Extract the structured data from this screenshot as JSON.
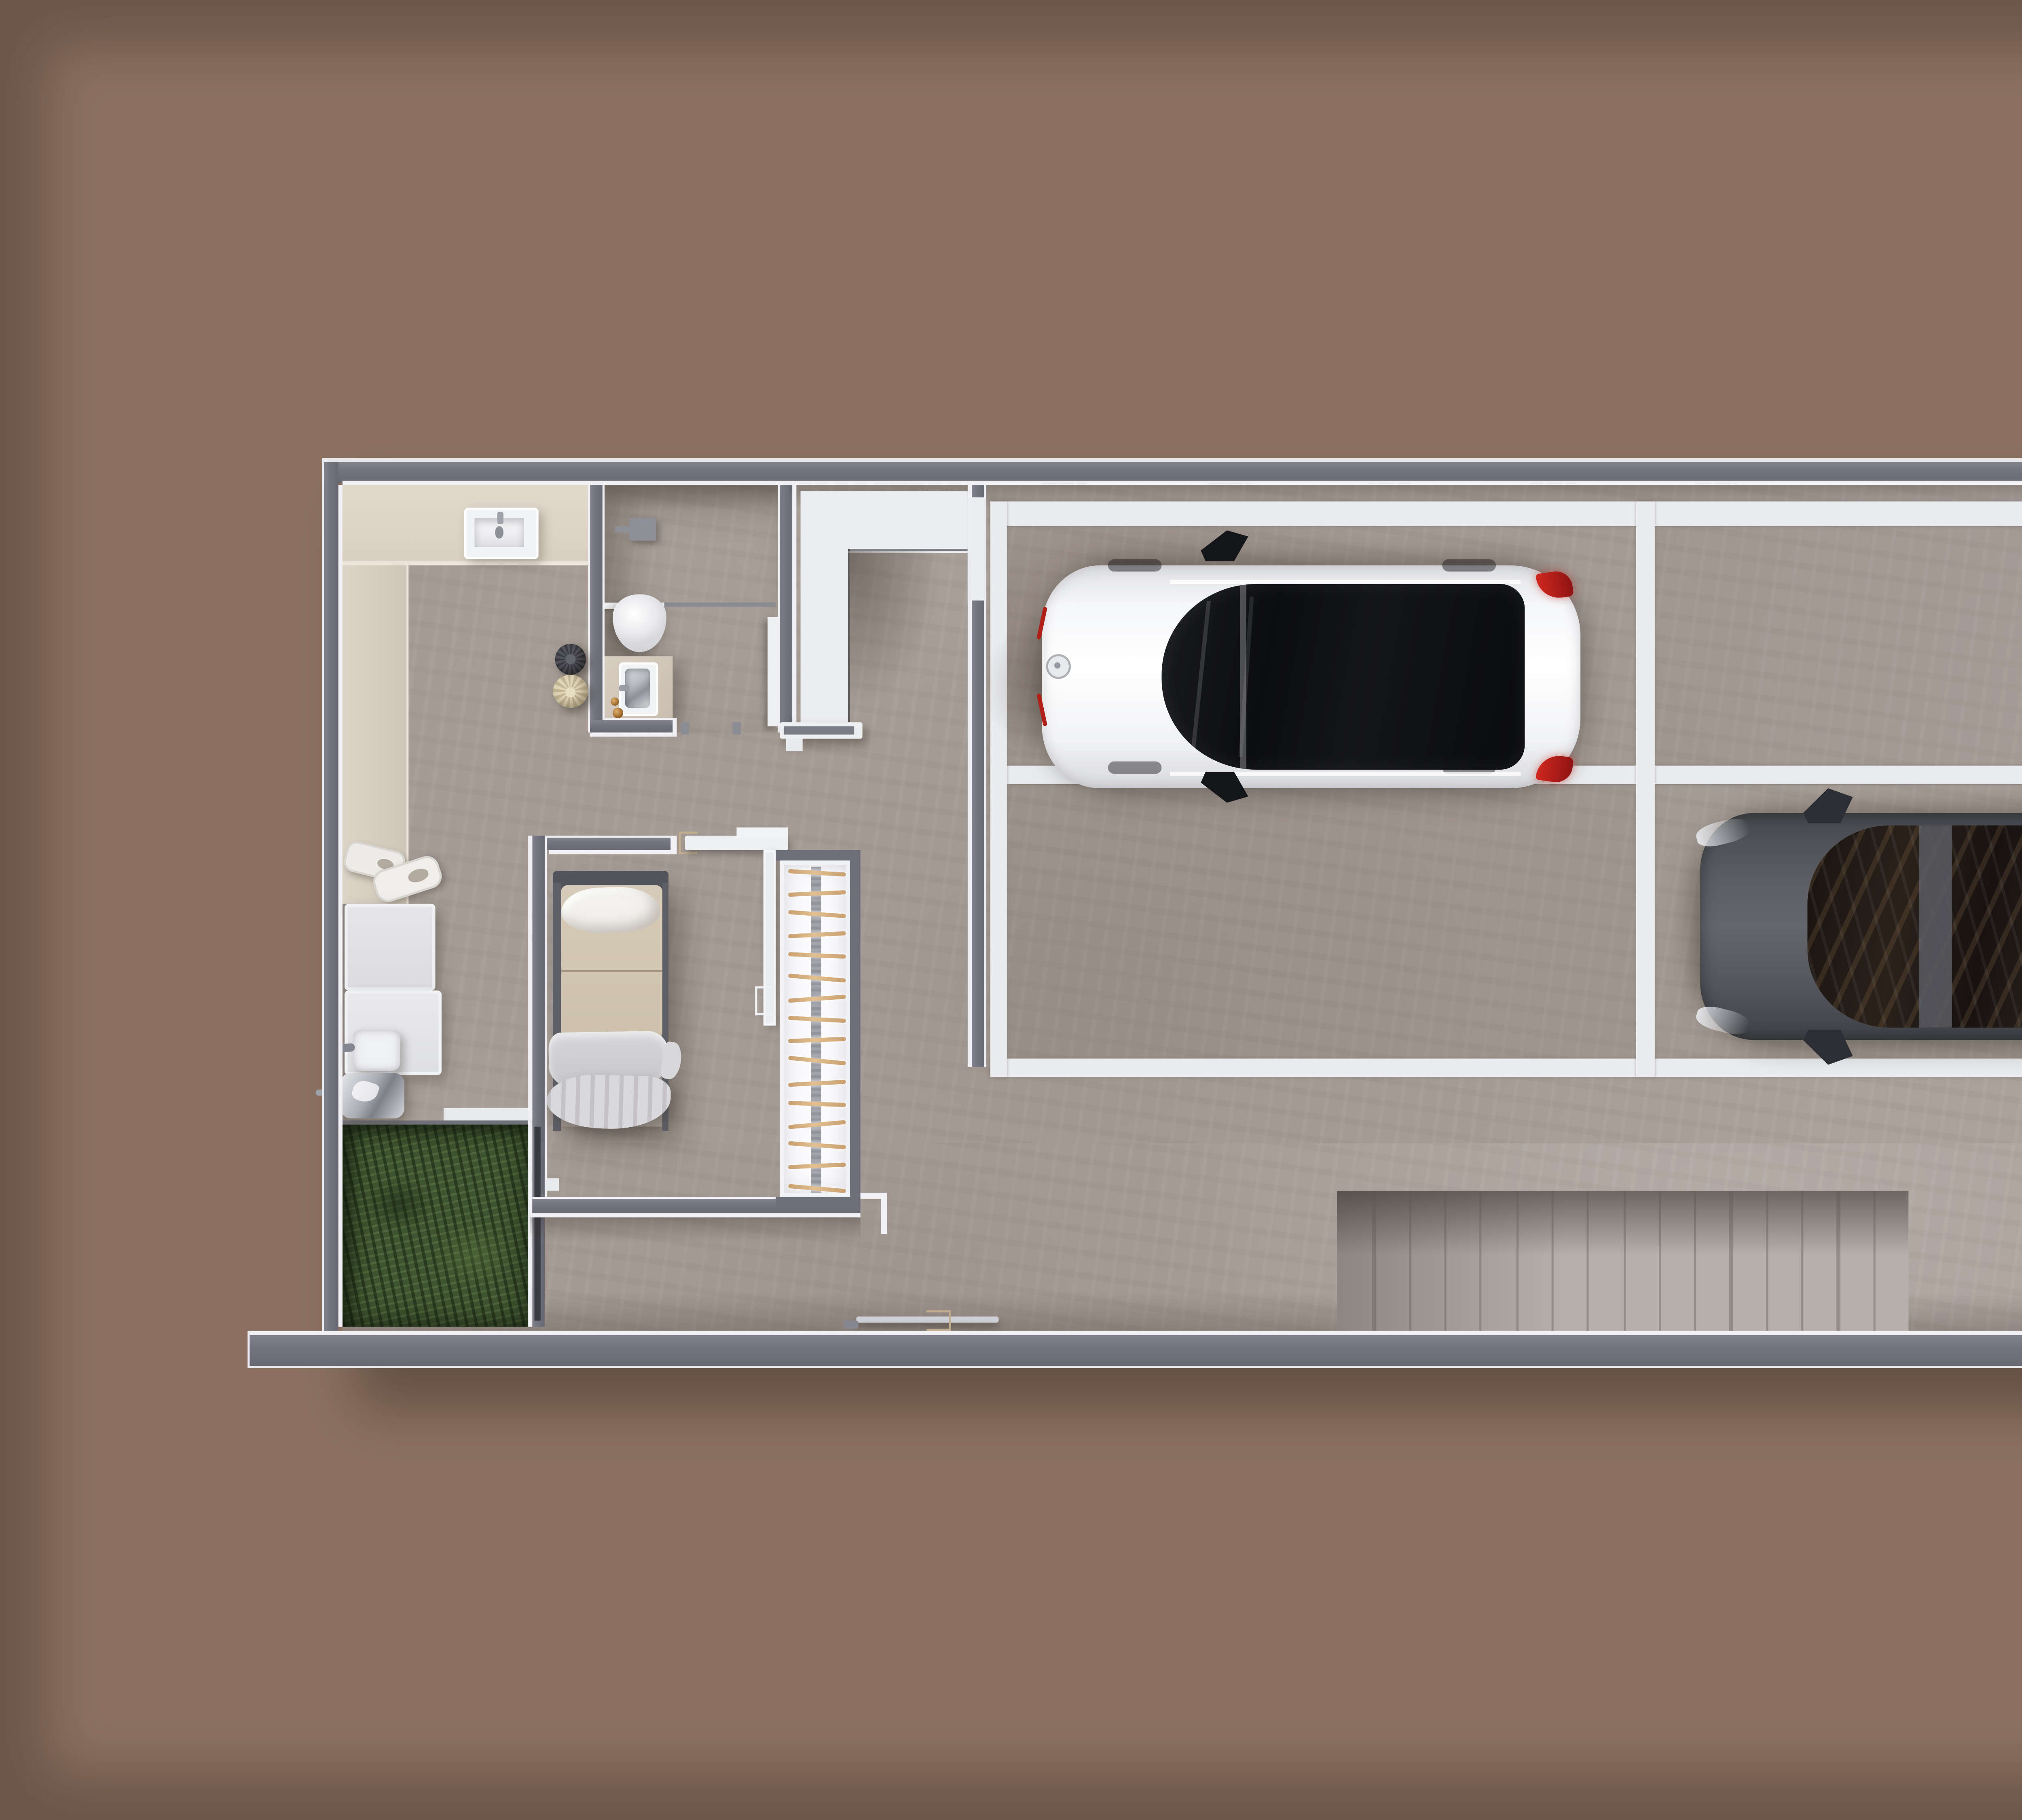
{
  "scene": {
    "kind": "architectural 3d floor plan, top-down render",
    "level": "ground / garage level with two parked cars"
  },
  "colors": {
    "background": "#8c7161",
    "wall": "#73747f",
    "trim": "#f1f1f5",
    "floor": "#aba19b",
    "floor_light": "#b7b0ab",
    "beige": "#d9cfc2",
    "white_floor": "#ecedf0",
    "grass": "#3f5430",
    "wood": "#c89f6f",
    "ramp": "#b6afab",
    "dark_box": "#4c4c55",
    "parking_line": "#eaecef",
    "white_car": "#f5f6f8",
    "dark_car": "#54565c",
    "red_light": "#c22018",
    "amber": "#a06a30",
    "tan": "#c2ad8f"
  },
  "rooms": [
    {
      "name": "kitchen",
      "features": [
        "l-shaped-counter",
        "sink",
        "appliances",
        "trays",
        "pan",
        "pot"
      ]
    },
    {
      "name": "bathroom",
      "features": [
        "toilet",
        "vanity-sink",
        "shower-fixture",
        "glass-screen",
        "door-leaf"
      ]
    },
    {
      "name": "entry-hall",
      "features": [
        "white-l-floor",
        "landing-rail"
      ]
    },
    {
      "name": "bedroom",
      "features": [
        "single-bed",
        "window-wall"
      ]
    },
    {
      "name": "stairwell",
      "features": [
        "wood-treads",
        "center-stringer"
      ]
    },
    {
      "name": "garage",
      "features": [
        "4-parking-bays",
        "white-markings"
      ]
    },
    {
      "name": "garden-patch",
      "features": [
        "grass"
      ]
    },
    {
      "name": "driveway-ramp",
      "features": [
        "plank-decking"
      ]
    },
    {
      "name": "entry-box",
      "features": [
        "dark-volume"
      ]
    }
  ],
  "parking": {
    "bays": 4,
    "occupied": 2,
    "cars": [
      {
        "name": "white-car",
        "color": "white",
        "facing": "left",
        "bay": "top-left"
      },
      {
        "name": "dark-car",
        "color": "graphite",
        "facing": "left",
        "bay": "bottom-right"
      }
    ]
  },
  "staircase": {
    "tread_count": 16,
    "tread_rotations": [
      3.5,
      -2.5,
      4,
      -3,
      2.5,
      5,
      -4,
      3,
      -2,
      5.5,
      -3,
      2,
      -5,
      4,
      -2.5,
      5
    ]
  },
  "ramp": {
    "plank_count": 16
  }
}
